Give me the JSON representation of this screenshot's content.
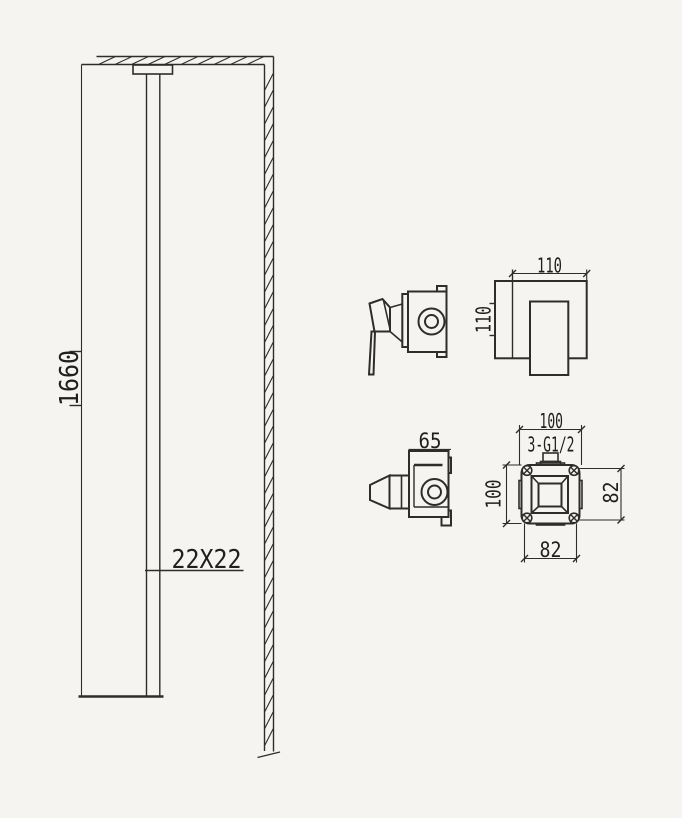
{
  "page": {
    "background": "#f5f4f1",
    "line_color": "#2e2d2b",
    "text_color": "#201f1d"
  },
  "views": {
    "elevation": {
      "column_height_label": "1660",
      "column_section_label": "22X22"
    },
    "mixer_trim_plate": {
      "width_label": "110",
      "height_label": "110"
    },
    "diverter_trim": {
      "depth_label": "65"
    },
    "rough_in_valve": {
      "width_label": "100",
      "height_label": "100",
      "connection_label": "3-G1/2",
      "mount_spacing_vertical_label": "82",
      "mount_spacing_horizontal_label": "82"
    }
  }
}
